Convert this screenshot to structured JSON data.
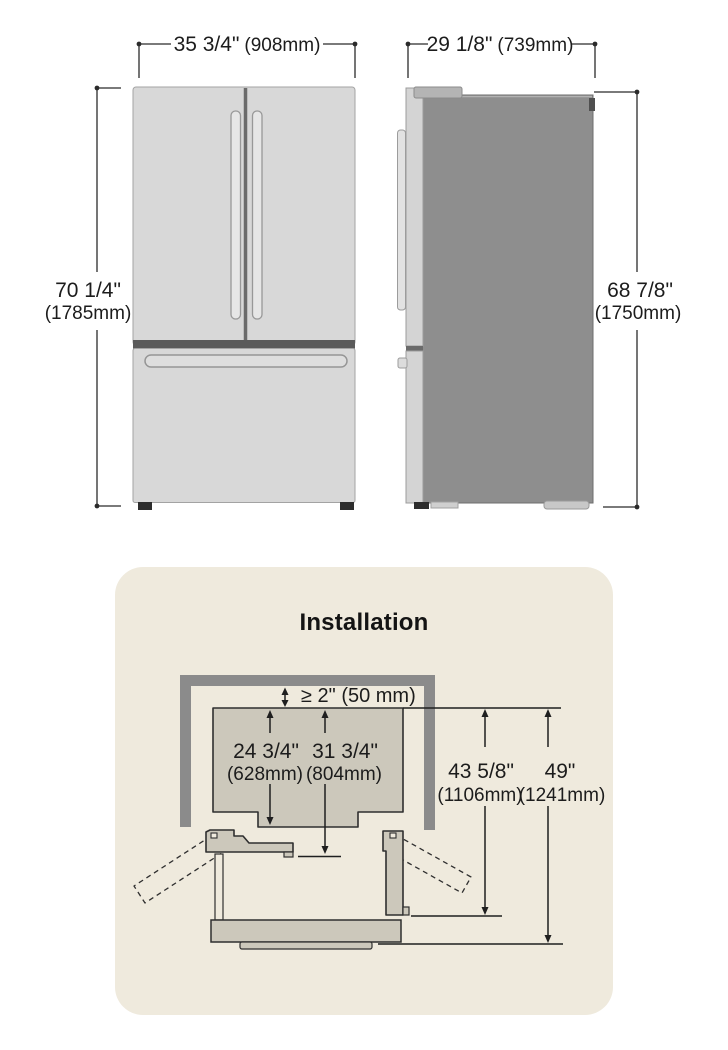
{
  "front_view": {
    "width_in": "35 3/4\"",
    "width_mm": "(908mm)",
    "height_in": "70 1/4\"",
    "height_mm": "(1785mm)"
  },
  "side_view": {
    "depth_in": "29 1/8\"",
    "depth_mm": "(739mm)",
    "height_in": "68 7/8\"",
    "height_mm": "(1750mm)"
  },
  "installation": {
    "title": "Installation",
    "rear_clearance": "≥ 2\" (50 mm)",
    "depth_without_doors_in": "24 3/4\"",
    "depth_without_doors_mm": "(628mm)",
    "depth_with_doors_in": "31 3/4\"",
    "depth_with_doors_mm": "(804mm)",
    "depth_doors_open_in": "43 5/8\"",
    "depth_doors_open_mm": "(1106mm)",
    "depth_total_in": "49\"",
    "depth_total_mm": "(1241mm)"
  },
  "colors": {
    "panel_background": "#efeadd",
    "fridge_front": "#d8d8d8",
    "fridge_side": "#8e8e8e",
    "wall": "#8b8b8b",
    "diagram_fill": "#ccc8bb",
    "dimension_text": "#1c1c1c"
  }
}
